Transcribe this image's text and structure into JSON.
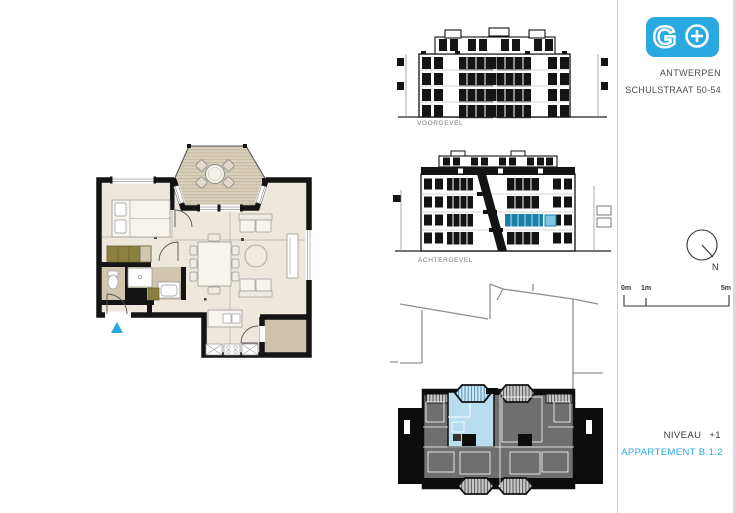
{
  "branding": {
    "logo_letter": "G",
    "plus_icon": "plus-in-circle",
    "brand_color": "#29A9E0",
    "city": "ANTWERPEN",
    "address": "SCHULSTRAAT 50-54"
  },
  "elevations": {
    "front_label": "VOORGEVEL",
    "rear_label": "ACHTERGEVEL"
  },
  "compass": {
    "north_label": "N"
  },
  "scale_bar": {
    "tick0": "0m",
    "tick1": "1m",
    "tick2": "5m"
  },
  "title_block": {
    "level_label": "NIVEAU",
    "level_value": "+1",
    "apartment_label": "APPARTEMENT B.1.2"
  },
  "colors": {
    "accent_blue": "#29A9E0",
    "wall_black": "#141414",
    "floor_beige": "#EDE7DC",
    "terrace_tan": "#CDC3AC",
    "deck_tan": "#D8CFBC",
    "cabinet_olive": "#8C8040",
    "site_building_gray": "#6F6F6F",
    "unit_highlight_blue": "#B7DDEF",
    "elevation_highlight": "#1B7FA6",
    "elevation_highlight_light": "#7FC8E2"
  }
}
